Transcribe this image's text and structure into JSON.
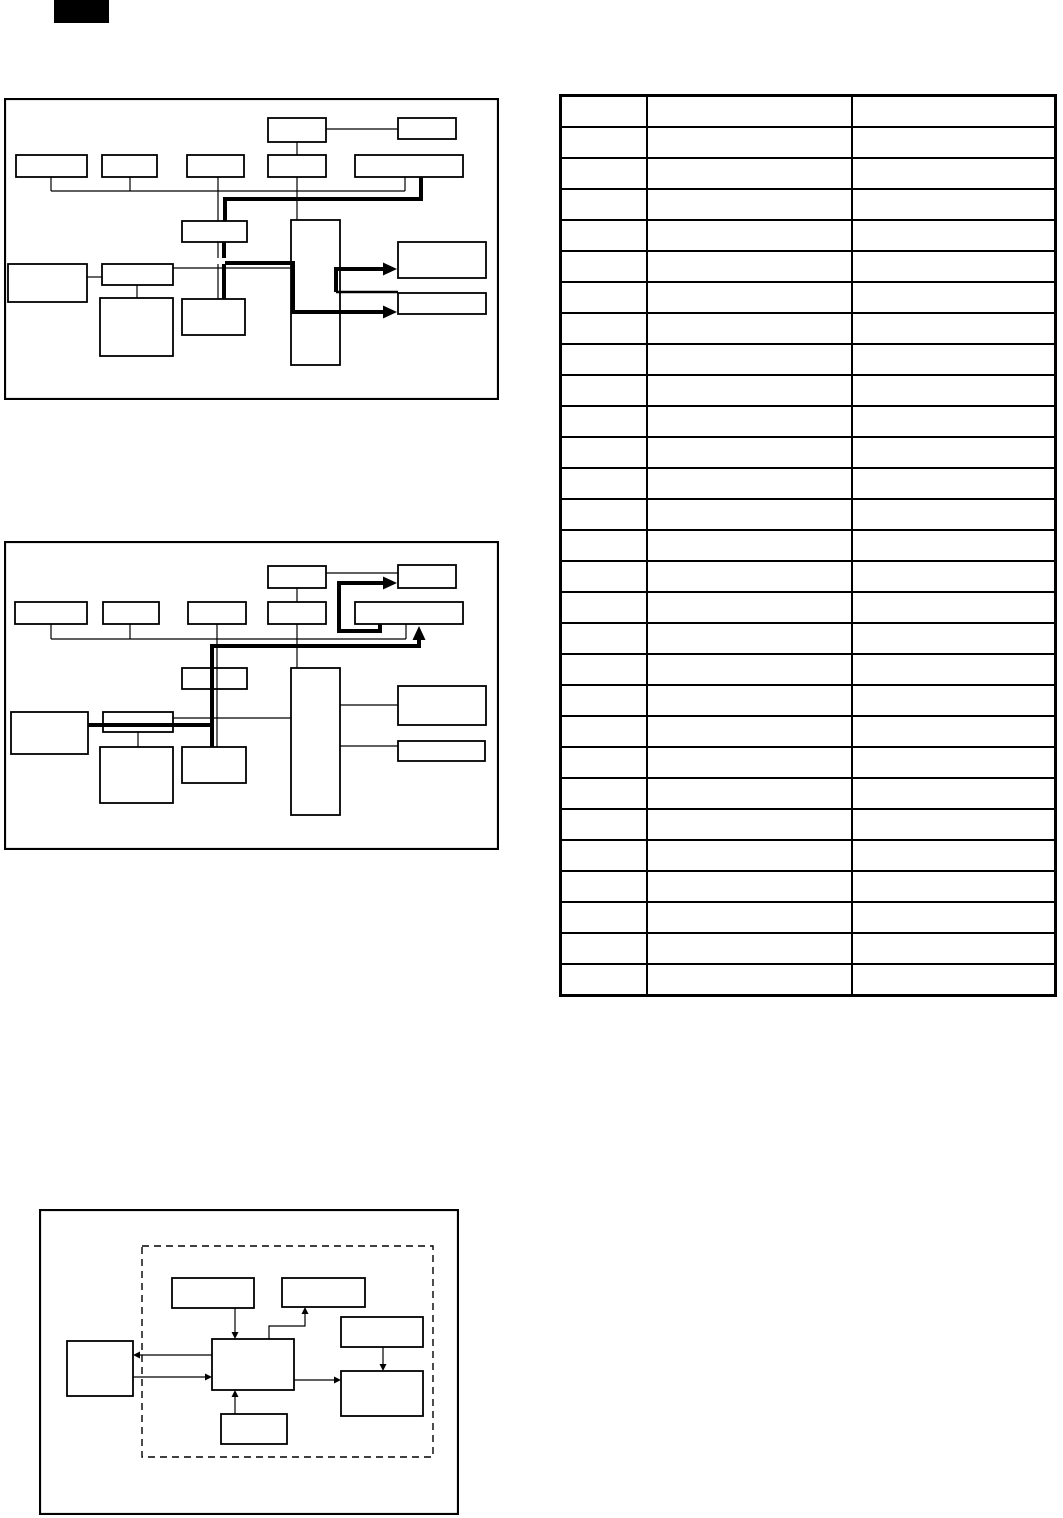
{
  "page": {
    "background_color": "#ffffff",
    "ink_color": "#000000",
    "width_px": 1063,
    "height_px": 1518
  },
  "corner_tab": {
    "fill_color": "#000000",
    "text": ""
  },
  "diagram1": {
    "type": "block-diagram",
    "box_count": 15,
    "thick_signal_arrows": 2,
    "all_boxes_empty": true
  },
  "diagram2": {
    "type": "block-diagram",
    "box_count": 15,
    "thick_signal_arrows": 2,
    "all_boxes_empty": true
  },
  "diagram3": {
    "type": "block-diagram",
    "box_count": 7,
    "arrow_count": 7,
    "has_dashed_boundary": true,
    "all_boxes_empty": true
  },
  "table": {
    "columns": 3,
    "rows": 29,
    "column_width_pct": [
      17.4,
      41.7,
      40.9
    ],
    "all_cells_empty": true
  }
}
